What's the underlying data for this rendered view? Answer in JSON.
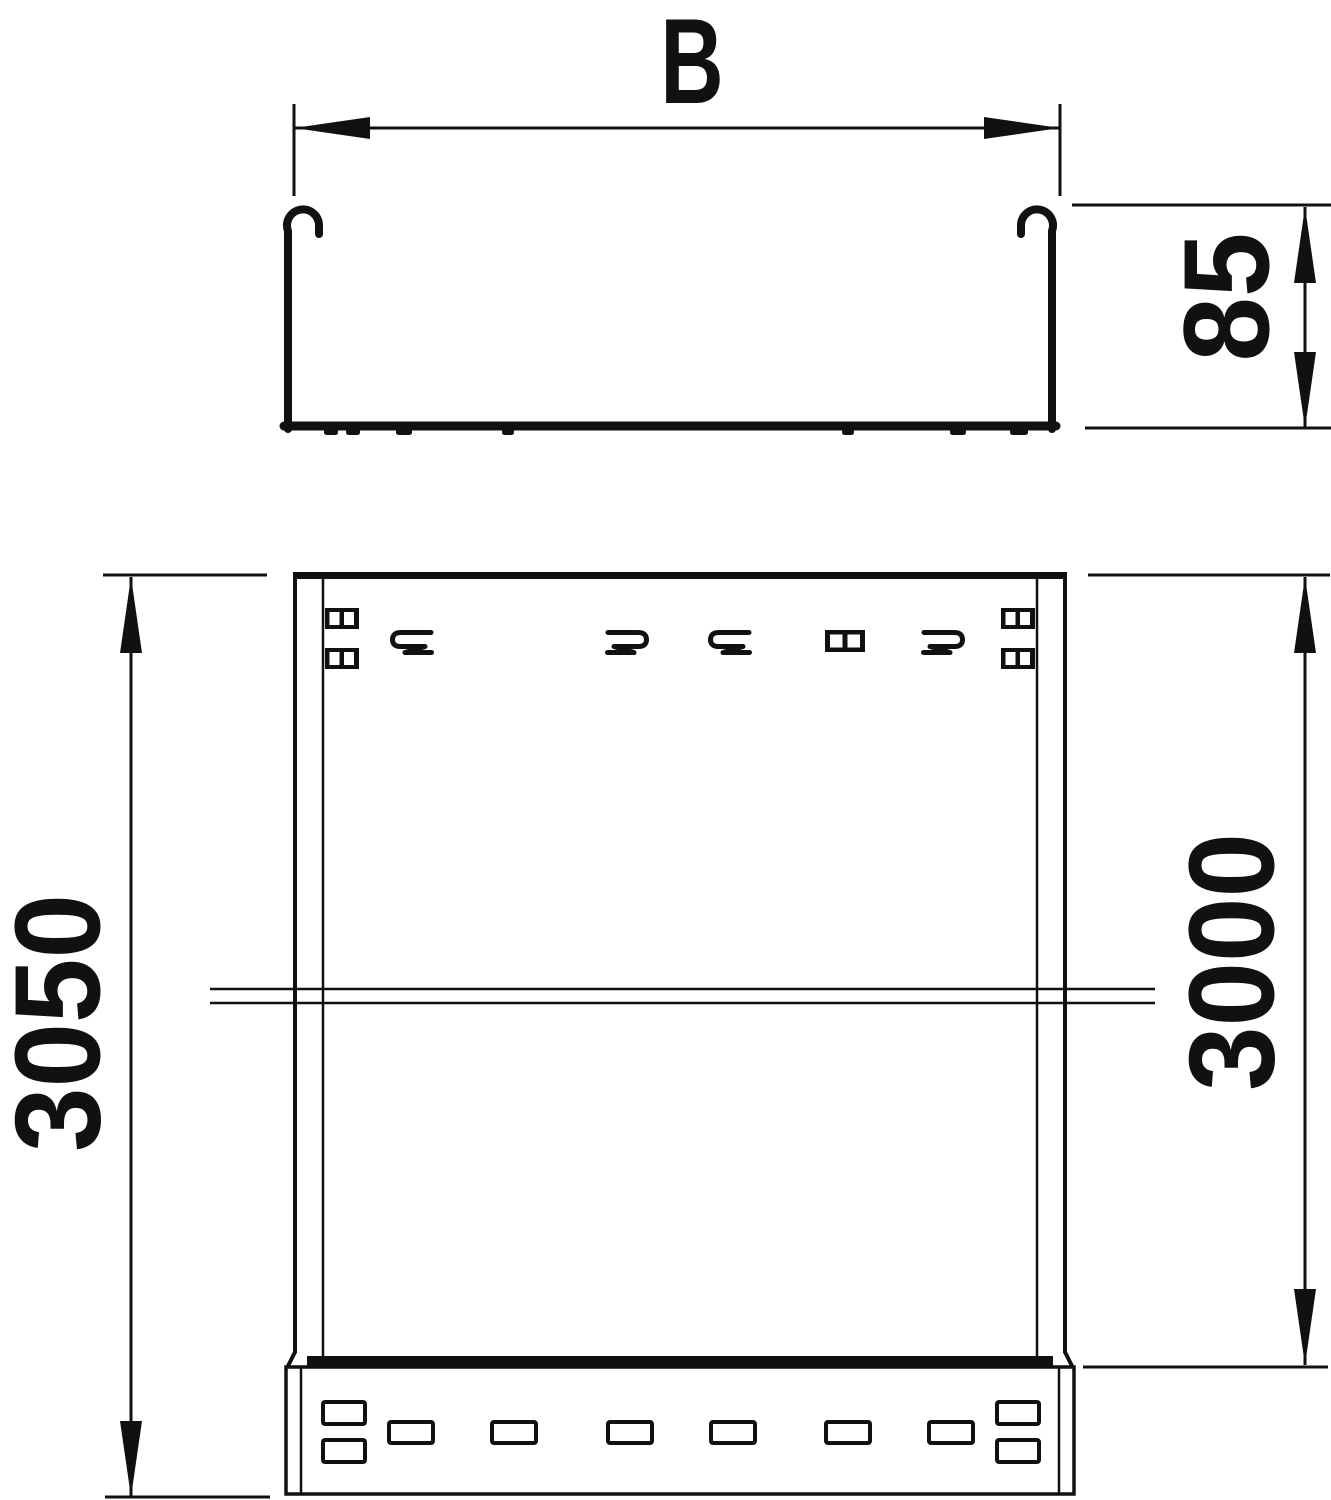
{
  "drawing": {
    "dimensions": {
      "width_label": "B",
      "height_label": "85",
      "overall_length_label": "3050",
      "section_length_label": "3000"
    },
    "colors": {
      "line": "#111111",
      "background": "#ffffff"
    }
  }
}
